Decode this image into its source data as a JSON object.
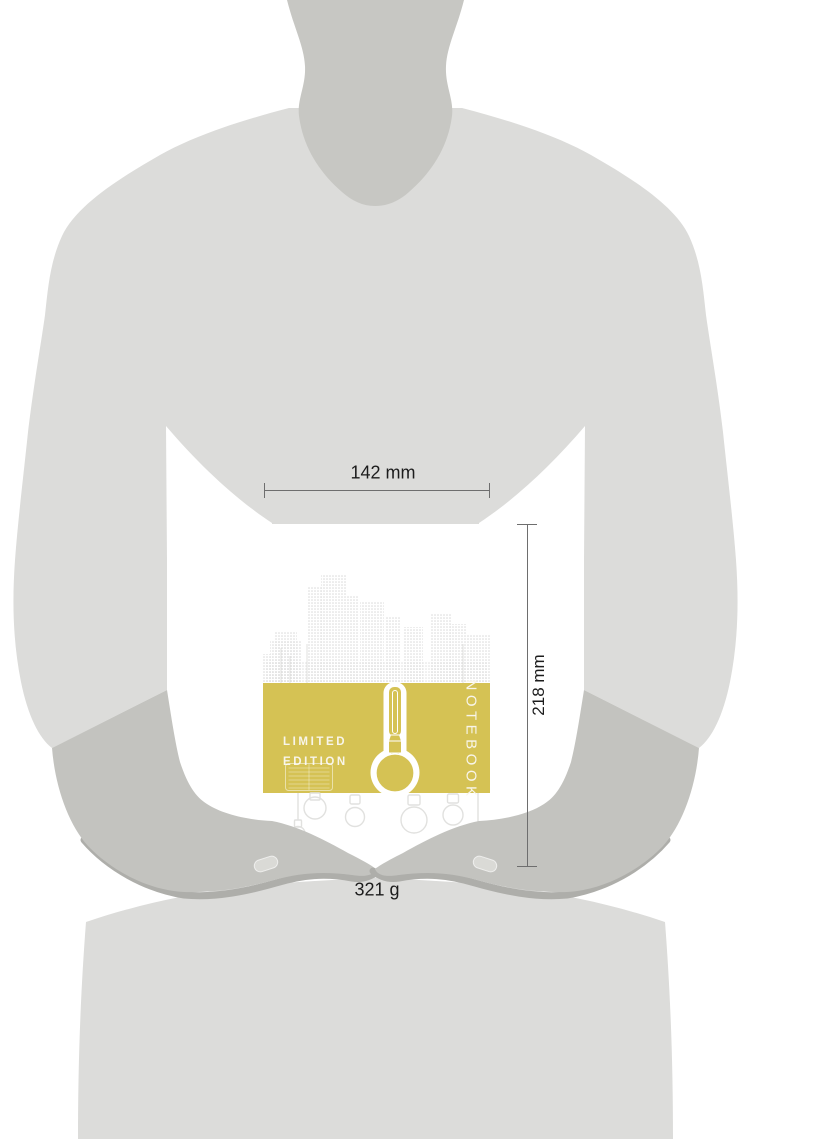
{
  "measurements": {
    "width": "142 mm",
    "height": "218 mm",
    "weight": "321 g"
  },
  "notebook_cover": {
    "badge_line1": "LIMITED",
    "badge_line2": "EDITION",
    "title": "NOTEBOOK"
  },
  "colors": {
    "accent-yellow": "#d5c254",
    "body-gray": "#dcdcda",
    "neck-gray": "#c7c7c3",
    "hand-gray": "#c3c3bf",
    "hand-shadow": "#aeaeaa",
    "nail": "#dadad6",
    "skyline-dot": "#d9d9d9",
    "bulb-outline": "#e1e1df",
    "dim-line": "#6e6e6e",
    "dim-text": "#1c1c1c",
    "cover-text": "#f8f5ea"
  }
}
